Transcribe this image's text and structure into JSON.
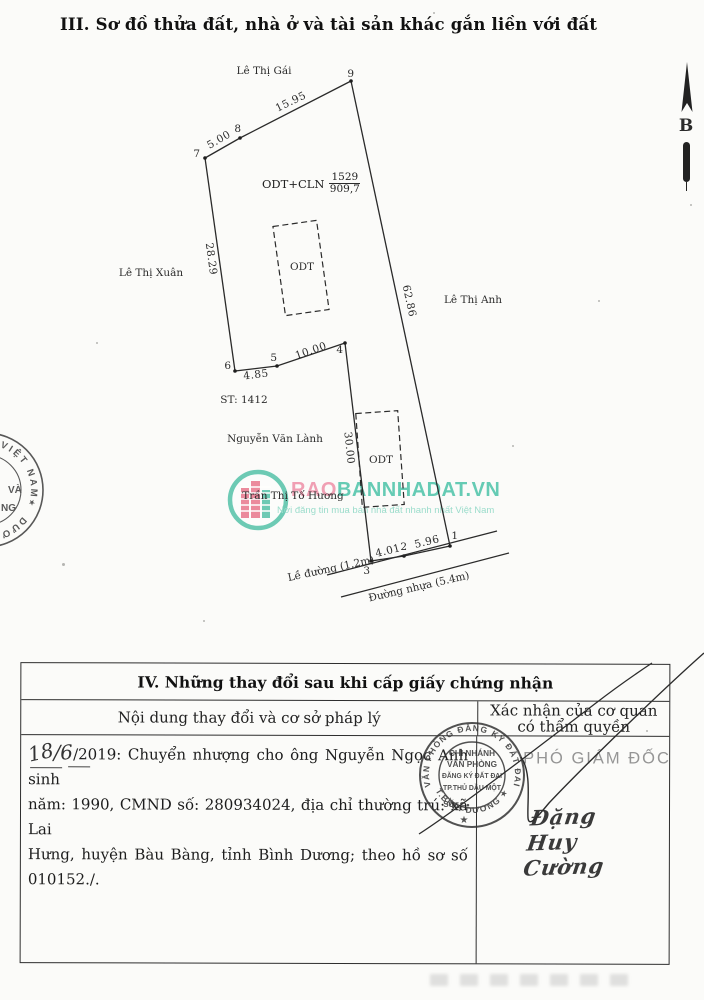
{
  "page_title": "III. Sơ đồ thửa đất, nhà ở và tài sản khác gắn liền với đất",
  "diagram": {
    "north": "B",
    "street_top": "Lê Thị Gái",
    "street_left": "Lê Thị Xuân",
    "street_right": "Lê Thị Anh",
    "curb_label": "Lề đường (1.2m)",
    "road_label": "Đường nhựa (5.4m)",
    "use_label": "ODT+CLN",
    "lot_number": "1529",
    "area": "909,7",
    "bldg_upper": "ODT",
    "bldg_lower": "ODT",
    "adjacent_ref": "ST: 1412",
    "neighbor1": "Nguyễn Văn Lành",
    "neighbor2": "Trần Thị Tố Hương",
    "vertices": [
      "1",
      "2",
      "3",
      "4",
      "5",
      "6",
      "7",
      "8",
      "9"
    ],
    "edges": {
      "v7_v8": "5.00",
      "v8_v9": "15.95",
      "v6_v7": "28.29",
      "v9_v1": "62.86",
      "v6_v5": "4.85",
      "v5_v4": "10.00",
      "v4_v3": "30.00",
      "v3_v2": "4.01",
      "v2_v1": "5.96"
    }
  },
  "watermark": {
    "brand_pink": "RAO",
    "brand_teal": "BANNHADAT.VN",
    "tagline": "Nơi đăng tin mua bán nhà đất nhanh nhất Việt Nam",
    "colors": {
      "pink": "#ee8ba4",
      "teal": "#45c1a5",
      "teal_light": "#86d6c2"
    }
  },
  "left_stamp": {
    "arc_top": "VIỆT NAM",
    "star": "★",
    "arc_bottom": "DƯƠNG",
    "frag1": "VÀ",
    "frag2": "NG"
  },
  "section4": {
    "title": "IV. Những thay đổi sau khi cấp giấy chứng nhận",
    "col_left_header": "Nội dung thay đổi và cơ sở pháp lý",
    "col_right_header_1": "Xác nhận của cơ quan",
    "col_right_header_2": "có thẩm quyền",
    "entry": {
      "day": "18",
      "slash": "/",
      "month": "6",
      "year_printed": "/2019:",
      "line1_rest": "Chuyển nhượng cho ông Nguyễn Ngọc Anh sinh",
      "line2": "năm: 1990, CMND số: 280934024, địa chỉ thường trú: xã Lai",
      "line3": "Hưng, huyện Bàu Bàng, tỉnh Bình Dương; theo hồ sơ số",
      "line4": "010152./."
    },
    "approver_title": "PHÓ GIÁM ĐỐC",
    "signature": "Đặng Huy Cường",
    "stamp": {
      "arc_top": "VĂN PHÒNG ĐĂNG KÝ ĐẤT ĐAI",
      "arc_bottom": "T.BÌNH DƯƠNG ★",
      "line1": "CHI NHÁNH",
      "line2": "VĂN PHÒNG",
      "line3": "ĐĂNG KÝ ĐẤT ĐAI",
      "line4": "TP.THỦ DẦU MỘT",
      "line5": "SỐ",
      "dot": "•",
      "star": "★"
    }
  }
}
